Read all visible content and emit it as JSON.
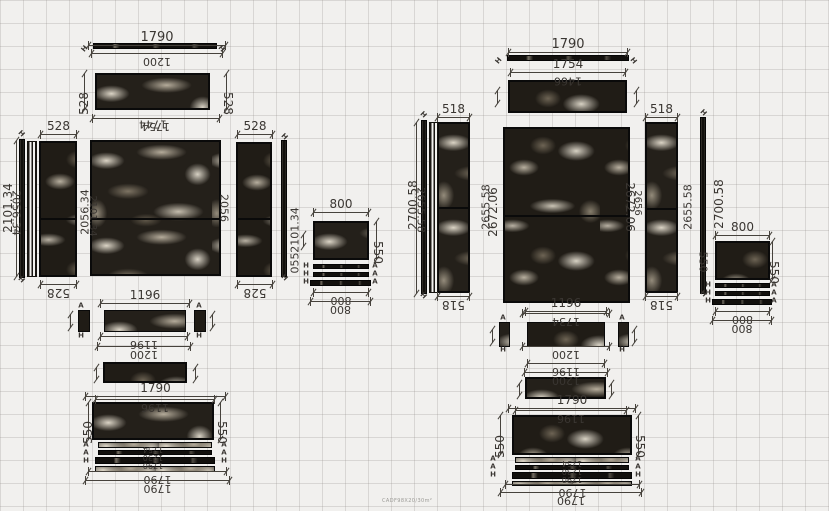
{
  "app": {
    "watermark": "CADF98X20/30m²"
  },
  "canvas": {
    "width": 829,
    "height": 511,
    "bg": "#f1f0ee",
    "grid_color": "#969490",
    "grid_size": 23,
    "line_color": "#46423c",
    "text_color": "#3a3632",
    "stone_dark": "#24201a",
    "vein_light": "#e5decf"
  },
  "drawing": {
    "panels": [
      {
        "x": 95,
        "y": 73,
        "w": 115,
        "h": 37,
        "t": "a"
      },
      {
        "x": 39,
        "y": 141,
        "w": 38,
        "h": 136,
        "t": "b",
        "split": 218
      },
      {
        "x": 90,
        "y": 140,
        "w": 131,
        "h": 136,
        "t": "a",
        "split": 218
      },
      {
        "x": 236,
        "y": 142,
        "w": 36,
        "h": 135,
        "t": "b",
        "split": 218
      },
      {
        "x": 313,
        "y": 221,
        "w": 56,
        "h": 39,
        "t": "a"
      },
      {
        "x": 78,
        "y": 310,
        "w": 12,
        "h": 22,
        "t": "b",
        "b": 1
      },
      {
        "x": 104,
        "y": 310,
        "w": 82,
        "h": 22,
        "t": "a",
        "b": 1
      },
      {
        "x": 194,
        "y": 310,
        "w": 12,
        "h": 22,
        "t": "b",
        "b": 1
      },
      {
        "x": 103,
        "y": 362,
        "w": 84,
        "h": 21,
        "t": "b"
      },
      {
        "x": 92,
        "y": 402,
        "w": 122,
        "h": 38,
        "t": "a"
      },
      {
        "x": 508,
        "y": 80,
        "w": 119,
        "h": 33,
        "t": "b"
      },
      {
        "x": 437,
        "y": 122,
        "w": 33,
        "h": 171,
        "t": "a",
        "split": 207
      },
      {
        "x": 503,
        "y": 127,
        "w": 127,
        "h": 176,
        "t": "b",
        "split": 215
      },
      {
        "x": 645,
        "y": 122,
        "w": 33,
        "h": 171,
        "t": "a",
        "split": 208
      },
      {
        "x": 715,
        "y": 241,
        "w": 55,
        "h": 39,
        "t": "b"
      },
      {
        "x": 499,
        "y": 322,
        "w": 11,
        "h": 25,
        "t": "a",
        "b": 1
      },
      {
        "x": 527,
        "y": 322,
        "w": 78,
        "h": 25,
        "t": "b",
        "b": 1
      },
      {
        "x": 618,
        "y": 322,
        "w": 11,
        "h": 25,
        "t": "a",
        "b": 1
      },
      {
        "x": 525,
        "y": 377,
        "w": 81,
        "h": 22,
        "t": "a"
      },
      {
        "x": 512,
        "y": 415,
        "w": 120,
        "h": 40,
        "t": "b"
      }
    ],
    "strips": [
      {
        "x": 93,
        "y": 43,
        "w": 124,
        "h": 6,
        "k": "edge"
      },
      {
        "x": 19,
        "y": 139,
        "w": 6,
        "h": 139,
        "k": "edge"
      },
      {
        "x": 27,
        "y": 141,
        "w": 10,
        "h": 136,
        "k": "lines"
      },
      {
        "x": 281,
        "y": 140,
        "w": 6,
        "h": 137,
        "k": "edge"
      },
      {
        "x": 313,
        "y": 264,
        "w": 56,
        "h": 5,
        "k": "edge"
      },
      {
        "x": 313,
        "y": 272,
        "w": 56,
        "h": 5,
        "k": "edge"
      },
      {
        "x": 310,
        "y": 280,
        "w": 61,
        "h": 6,
        "k": "edge"
      },
      {
        "x": 98,
        "y": 442,
        "w": 114,
        "h": 6,
        "k": "mthin"
      },
      {
        "x": 98,
        "y": 450,
        "w": 114,
        "h": 5,
        "k": "edge"
      },
      {
        "x": 95,
        "y": 457,
        "w": 120,
        "h": 7,
        "k": "edge"
      },
      {
        "x": 95,
        "y": 466,
        "w": 120,
        "h": 6,
        "k": "mthin"
      },
      {
        "x": 507,
        "y": 55,
        "w": 122,
        "h": 6,
        "k": "edge"
      },
      {
        "x": 421,
        "y": 120,
        "w": 6,
        "h": 174,
        "k": "edge"
      },
      {
        "x": 429,
        "y": 122,
        "w": 9,
        "h": 171,
        "k": "lines"
      },
      {
        "x": 700,
        "y": 117,
        "w": 6,
        "h": 177,
        "k": "edge"
      },
      {
        "x": 715,
        "y": 283,
        "w": 55,
        "h": 5,
        "k": "edge"
      },
      {
        "x": 715,
        "y": 291,
        "w": 55,
        "h": 5,
        "k": "edge"
      },
      {
        "x": 712,
        "y": 299,
        "w": 60,
        "h": 6,
        "k": "edge"
      },
      {
        "x": 515,
        "y": 457,
        "w": 114,
        "h": 6,
        "k": "mthin"
      },
      {
        "x": 515,
        "y": 465,
        "w": 114,
        "h": 5,
        "k": "edge"
      },
      {
        "x": 512,
        "y": 472,
        "w": 120,
        "h": 7,
        "k": "edge"
      },
      {
        "x": 512,
        "y": 481,
        "w": 120,
        "h": 5,
        "k": "mthin"
      }
    ],
    "hdims": [
      {
        "x": 88,
        "y": 45,
        "w": 138,
        "label": "1790",
        "fs": 13
      },
      {
        "x": 91,
        "y": 53,
        "w": 132,
        "label": "1200",
        "flip": 1
      },
      {
        "x": 92,
        "y": 118,
        "w": 128,
        "label": "1754",
        "flip": 1
      },
      {
        "x": 40,
        "y": 134,
        "w": 37,
        "label": "528",
        "fs": 12
      },
      {
        "x": 237,
        "y": 134,
        "w": 36,
        "label": "528",
        "fs": 12
      },
      {
        "x": 40,
        "y": 284,
        "w": 37,
        "label": "528",
        "flip": 1,
        "fs": 12
      },
      {
        "x": 237,
        "y": 284,
        "w": 36,
        "label": "528",
        "flip": 1,
        "fs": 12
      },
      {
        "x": 313,
        "y": 212,
        "w": 56,
        "label": "800",
        "fs": 12
      },
      {
        "x": 313,
        "y": 292,
        "w": 56,
        "label": "800",
        "flip": 1
      },
      {
        "x": 310,
        "y": 301,
        "w": 61,
        "label": "800",
        "flip": 1
      },
      {
        "x": 100,
        "y": 303,
        "w": 90,
        "label": "1196",
        "fs": 12
      },
      {
        "x": 100,
        "y": 336,
        "w": 88,
        "label": "1196",
        "flip": 1
      },
      {
        "x": 97,
        "y": 346,
        "w": 94,
        "label": "1200",
        "flip": 1
      },
      {
        "x": 85,
        "y": 396,
        "w": 141,
        "label": "1790",
        "fs": 12
      },
      {
        "x": 95,
        "y": 399,
        "w": 120,
        "label": "1196",
        "flip": 1
      },
      {
        "x": 88,
        "y": 471,
        "w": 139,
        "label": "1790",
        "flip": 1
      },
      {
        "x": 85,
        "y": 480,
        "w": 145,
        "label": "1790",
        "flip": 1
      },
      {
        "x": 508,
        "y": 52,
        "w": 120,
        "label": "1790",
        "fs": 13
      },
      {
        "x": 510,
        "y": 72,
        "w": 116,
        "label": "1754",
        "fs": 12
      },
      {
        "x": 437,
        "y": 117,
        "w": 33,
        "label": "518",
        "fs": 12
      },
      {
        "x": 645,
        "y": 117,
        "w": 33,
        "label": "518",
        "fs": 12
      },
      {
        "x": 437,
        "y": 296,
        "w": 33,
        "label": "518",
        "flip": 1,
        "fs": 12
      },
      {
        "x": 645,
        "y": 296,
        "w": 33,
        "label": "518",
        "flip": 1,
        "fs": 12
      },
      {
        "x": 715,
        "y": 235,
        "w": 55,
        "label": "800",
        "fs": 12
      },
      {
        "x": 715,
        "y": 311,
        "w": 55,
        "label": "800",
        "flip": 1
      },
      {
        "x": 712,
        "y": 320,
        "w": 60,
        "label": "800",
        "flip": 1
      },
      {
        "x": 525,
        "y": 311,
        "w": 82,
        "label": "1196",
        "fs": 12
      },
      {
        "x": 522,
        "y": 313,
        "w": 88,
        "label": "1734",
        "flip": 1
      },
      {
        "x": 522,
        "y": 346,
        "w": 88,
        "label": "1200",
        "flip": 1
      },
      {
        "x": 527,
        "y": 363,
        "w": 78,
        "label": "1196",
        "flip": 1
      },
      {
        "x": 524,
        "y": 372,
        "w": 84,
        "label": "1200",
        "flip": 1
      },
      {
        "x": 508,
        "y": 408,
        "w": 128,
        "label": "1790",
        "fs": 12
      },
      {
        "x": 515,
        "y": 410,
        "w": 112,
        "label": "1196",
        "flip": 1
      },
      {
        "x": 505,
        "y": 484,
        "w": 135,
        "label": "1790",
        "flip": 1
      },
      {
        "x": 500,
        "y": 492,
        "w": 142,
        "label": "1790",
        "flip": 1
      }
    ],
    "vdims": [
      {
        "x": 84,
        "y": 73,
        "h": 37,
        "label": "528",
        "side": "left",
        "fs": 12
      },
      {
        "x": 226,
        "y": 73,
        "h": 37,
        "label": "528",
        "side": "right",
        "fs": 12
      },
      {
        "x": 16,
        "y": 140,
        "h": 137,
        "label": ""
      },
      {
        "x": 376,
        "y": 221,
        "h": 39,
        "label": "550",
        "side": "right",
        "fs": 12
      },
      {
        "x": 88,
        "y": 402,
        "h": 38,
        "label": "550",
        "side": "left",
        "fs": 12
      },
      {
        "x": 220,
        "y": 402,
        "h": 38,
        "label": "550",
        "side": "right",
        "fs": 12
      },
      {
        "x": 416,
        "y": 122,
        "h": 172,
        "label": ""
      },
      {
        "x": 772,
        "y": 241,
        "h": 39,
        "label": "550",
        "side": "right",
        "fs": 12
      },
      {
        "x": 500,
        "y": 415,
        "h": 40,
        "label": "550",
        "side": "left",
        "fs": 12
      },
      {
        "x": 638,
        "y": 415,
        "h": 40,
        "label": "550",
        "side": "right",
        "fs": 12
      }
    ],
    "vticks": [
      {
        "x": 70,
        "y": 314,
        "h": 14
      },
      {
        "x": 212,
        "y": 314,
        "h": 14
      },
      {
        "x": 96,
        "y": 367,
        "h": 13
      },
      {
        "x": 195,
        "y": 367,
        "h": 13
      },
      {
        "x": 303,
        "y": 234,
        "h": 13
      },
      {
        "x": 497,
        "y": 90,
        "h": 14
      },
      {
        "x": 636,
        "y": 90,
        "h": 14
      },
      {
        "x": 492,
        "y": 329,
        "h": 14
      },
      {
        "x": 634,
        "y": 329,
        "h": 14
      },
      {
        "x": 519,
        "y": 383,
        "h": 13
      },
      {
        "x": 611,
        "y": 383,
        "h": 13
      }
    ],
    "texts": [
      {
        "x": 153,
        "y": 124,
        "label": "1744",
        "rot": 180,
        "fs": 11
      },
      {
        "x": 8,
        "y": 208,
        "label": "2101.34",
        "rot": -90,
        "fs": 12
      },
      {
        "x": 16,
        "y": 213,
        "label": "2056.34",
        "rot": 90,
        "fs": 11
      },
      {
        "x": 85,
        "y": 212,
        "label": "2056.34",
        "rot": -90,
        "fs": 11
      },
      {
        "x": 92,
        "y": 216,
        "label": "2101.34",
        "rot": 90,
        "fs": 10
      },
      {
        "x": 224,
        "y": 208,
        "label": "2056",
        "rot": 90,
        "fs": 11
      },
      {
        "x": 295,
        "y": 230,
        "label": "2101.34",
        "rot": -90,
        "fs": 11
      },
      {
        "x": 295,
        "y": 263,
        "label": "055",
        "rot": -90,
        "fs": 11
      },
      {
        "x": 153,
        "y": 449,
        "label": "1754",
        "rot": 180,
        "fs": 8
      },
      {
        "x": 153,
        "y": 457,
        "label": "1230",
        "rot": 180,
        "fs": 8
      },
      {
        "x": 153,
        "y": 465,
        "label": "1790",
        "rot": 180,
        "fs": 8
      },
      {
        "x": 568,
        "y": 81,
        "label": "1466",
        "rot": 180,
        "fs": 11
      },
      {
        "x": 413,
        "y": 205,
        "label": "2700.58",
        "rot": -90,
        "fs": 12
      },
      {
        "x": 421,
        "y": 210,
        "label": "2655.58",
        "rot": 90,
        "fs": 11
      },
      {
        "x": 486,
        "y": 207,
        "label": "2655.58",
        "rot": -90,
        "fs": 11
      },
      {
        "x": 493,
        "y": 212,
        "label": "2672.06",
        "rot": -90,
        "fs": 12
      },
      {
        "x": 630,
        "y": 207,
        "label": "2672.06",
        "rot": 90,
        "fs": 12
      },
      {
        "x": 637,
        "y": 203,
        "label": "2656",
        "rot": 90,
        "fs": 10
      },
      {
        "x": 688,
        "y": 207,
        "label": "2655.58",
        "rot": -90,
        "fs": 11
      },
      {
        "x": 719,
        "y": 204,
        "label": "2700.58",
        "rot": -90,
        "fs": 12
      },
      {
        "x": 703,
        "y": 262,
        "label": "550",
        "rot": 90,
        "fs": 11
      },
      {
        "x": 572,
        "y": 463,
        "label": "1754",
        "rot": 180,
        "fs": 8
      },
      {
        "x": 572,
        "y": 471,
        "label": "1230",
        "rot": 180,
        "fs": 8
      },
      {
        "x": 572,
        "y": 479,
        "label": "1790",
        "rot": 180,
        "fs": 8
      }
    ],
    "markers": [
      {
        "x": 85,
        "y": 49,
        "label": "H",
        "rot": -50
      },
      {
        "x": 221,
        "y": 49,
        "label": "H",
        "rot": 50
      },
      {
        "x": 21,
        "y": 134,
        "label": "H",
        "rot": 45
      },
      {
        "x": 21,
        "y": 280,
        "label": "H",
        "rot": 45
      },
      {
        "x": 284,
        "y": 137,
        "label": "H",
        "rot": 45
      },
      {
        "x": 284,
        "y": 278,
        "label": "H",
        "rot": 45
      },
      {
        "x": 81,
        "y": 306,
        "label": "A"
      },
      {
        "x": 81,
        "y": 336,
        "label": "H"
      },
      {
        "x": 199,
        "y": 306,
        "label": "A"
      },
      {
        "x": 199,
        "y": 336,
        "label": "H"
      },
      {
        "x": 306,
        "y": 266,
        "label": "H"
      },
      {
        "x": 306,
        "y": 274,
        "label": "H"
      },
      {
        "x": 306,
        "y": 282,
        "label": "H"
      },
      {
        "x": 375,
        "y": 266,
        "label": "A"
      },
      {
        "x": 375,
        "y": 274,
        "label": "A"
      },
      {
        "x": 375,
        "y": 282,
        "label": "A"
      },
      {
        "x": 86,
        "y": 445,
        "label": "A"
      },
      {
        "x": 86,
        "y": 453,
        "label": "A"
      },
      {
        "x": 86,
        "y": 461,
        "label": "H"
      },
      {
        "x": 224,
        "y": 445,
        "label": "A"
      },
      {
        "x": 224,
        "y": 453,
        "label": "A"
      },
      {
        "x": 224,
        "y": 461,
        "label": "H"
      },
      {
        "x": 499,
        "y": 61,
        "label": "H",
        "rot": -50
      },
      {
        "x": 633,
        "y": 61,
        "label": "H",
        "rot": 50
      },
      {
        "x": 423,
        "y": 115,
        "label": "H",
        "rot": 45
      },
      {
        "x": 423,
        "y": 296,
        "label": "H",
        "rot": 45
      },
      {
        "x": 703,
        "y": 113,
        "label": "H",
        "rot": 45
      },
      {
        "x": 703,
        "y": 294,
        "label": "H",
        "rot": 45
      },
      {
        "x": 503,
        "y": 318,
        "label": "A"
      },
      {
        "x": 503,
        "y": 350,
        "label": "H"
      },
      {
        "x": 622,
        "y": 318,
        "label": "A"
      },
      {
        "x": 622,
        "y": 350,
        "label": "H"
      },
      {
        "x": 708,
        "y": 285,
        "label": "H"
      },
      {
        "x": 708,
        "y": 293,
        "label": "H"
      },
      {
        "x": 708,
        "y": 301,
        "label": "H"
      },
      {
        "x": 774,
        "y": 285,
        "label": "A"
      },
      {
        "x": 774,
        "y": 293,
        "label": "A"
      },
      {
        "x": 774,
        "y": 301,
        "label": "A"
      },
      {
        "x": 493,
        "y": 459,
        "label": "A"
      },
      {
        "x": 493,
        "y": 467,
        "label": "A"
      },
      {
        "x": 493,
        "y": 475,
        "label": "H"
      },
      {
        "x": 638,
        "y": 459,
        "label": "A"
      },
      {
        "x": 638,
        "y": 467,
        "label": "A"
      },
      {
        "x": 638,
        "y": 475,
        "label": "H"
      }
    ]
  }
}
